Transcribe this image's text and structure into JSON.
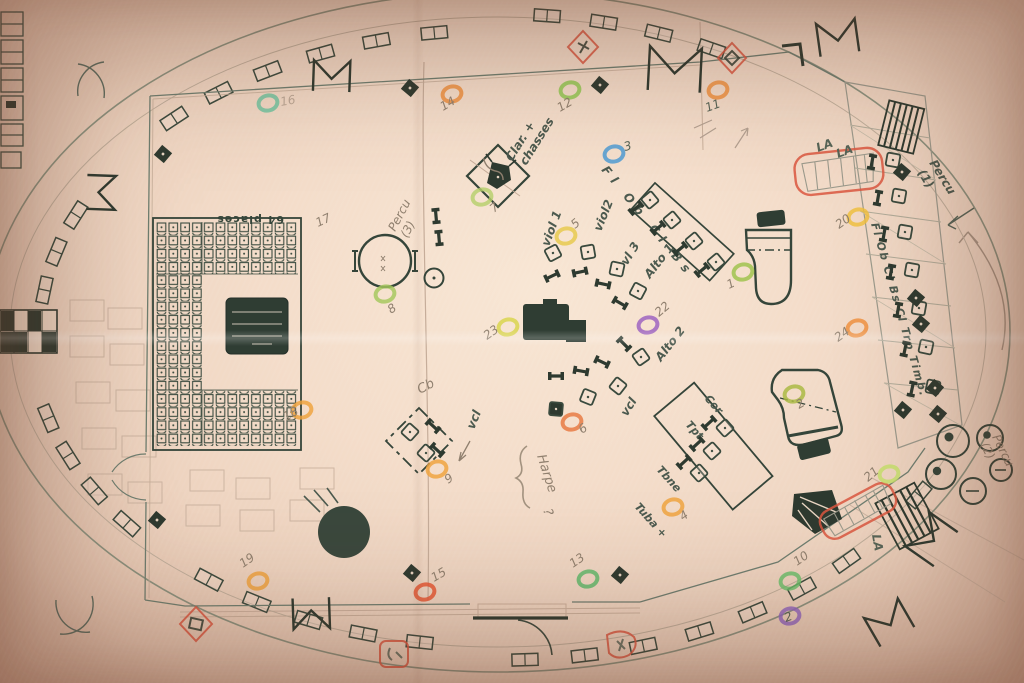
{
  "colors": {
    "ink": "#3a4a3e",
    "ink_dark": "#2e3a30",
    "pencil": "#90806f",
    "pencil_dark": "#566457",
    "red_pen": "#da5740",
    "paper": "#f4ddca"
  },
  "labels": {
    "seat_block": "64 places",
    "clarinet_line1": "Clar. +",
    "clarinet_line2": "chasses",
    "percussion3_line1": "Percu",
    "percussion3_line2": "(3)",
    "percussion1_line1": "Percu",
    "percussion1_line2": "(1)",
    "percussion2_line1": "Percu",
    "percussion2_line2": "(2)",
    "violin1": "viol 1",
    "violin2": "viol2",
    "violin3": "vl 3",
    "alto1": "Alto 1",
    "alto2": "Alto 2",
    "cello_a": "vcl",
    "cello_b": "vcl",
    "winds_row": "Fl  Ob  Cl  Bs",
    "risers_column": "Fl Ob Cl Bs Cl Trp Timb.",
    "contrabass": "Cb",
    "harp": "Harpe",
    "harp_mark": "?",
    "horn": "Cor",
    "trumpet": "Tpt",
    "trombone": "Tbne",
    "tuba": "Tuba +",
    "la_1": "LA",
    "la_2": "LA",
    "la_3": "LA"
  },
  "markers": [
    {
      "v": "1",
      "c": "#9ec24a"
    },
    {
      "v": "2",
      "c": "#a8b840"
    },
    {
      "v": "3",
      "c": "#4a9ad4"
    },
    {
      "v": "4",
      "c": "#efa23c"
    },
    {
      "v": "5",
      "c": "#e6c94b"
    },
    {
      "v": "6",
      "c": "#e87840"
    },
    {
      "v": "7",
      "c": "#b6cf6b"
    },
    {
      "v": "8",
      "c": "#a3c75c"
    },
    {
      "v": "9",
      "c": "#efa23c"
    },
    {
      "v": "10",
      "c": "#69c06a"
    },
    {
      "v": "11",
      "c": "#ef8f3c"
    },
    {
      "v": "12",
      "c": "#8fc94f"
    },
    {
      "v": "13",
      "c": "#5bb96a"
    },
    {
      "v": "14",
      "c": "#ef8f3c"
    },
    {
      "v": "15",
      "c": "#e8542f"
    },
    {
      "v": "16",
      "c": "#6cc4a0"
    },
    {
      "v": "17",
      "c": "none"
    },
    {
      "v": "18",
      "c": "#efa23c"
    },
    {
      "v": "19",
      "c": "#efa23c"
    },
    {
      "v": "20",
      "c": "#efbf3c"
    },
    {
      "v": "21",
      "c": "#c6e06a"
    },
    {
      "v": "22",
      "c": "#9a5fc0"
    },
    {
      "v": "23",
      "c": "#d8d44a"
    },
    {
      "v": "24",
      "c": "#ef8f3c"
    },
    {
      "v": "2",
      "c": "#8f64c0"
    }
  ]
}
